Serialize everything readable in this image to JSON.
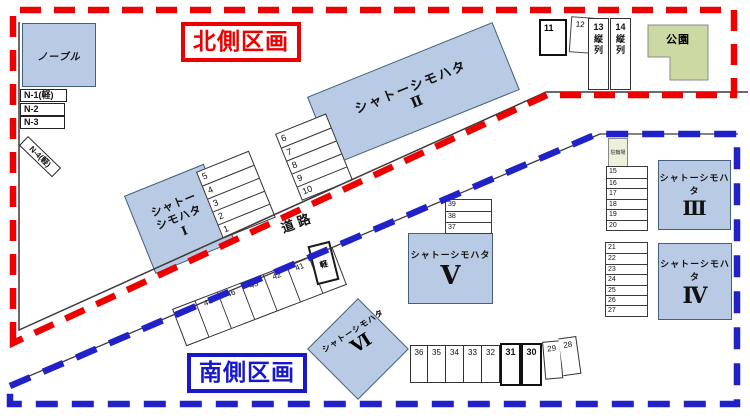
{
  "regions": {
    "north_label": "北側区画",
    "south_label": "南側区画"
  },
  "road_label": "道路",
  "buildings": {
    "noble": "ノーブル",
    "b1": {
      "line1": "シャトー",
      "line2": "シモハタ",
      "numeral": "Ⅰ"
    },
    "b2": {
      "name": "シャトーシモハタ",
      "numeral": "Ⅱ"
    },
    "b3": {
      "name": "シャトーシモハタ",
      "numeral": "Ⅲ"
    },
    "b4": {
      "name": "シャトーシモハタ",
      "numeral": "Ⅳ"
    },
    "b5": {
      "name": "シャトーシモハタ",
      "numeral": "Ⅴ"
    },
    "b6": {
      "name": "シャトーシモハタ",
      "numeral": "Ⅵ"
    },
    "park": "公園",
    "bicycle_shed": "駐輪場"
  },
  "spaces": {
    "n_row": [
      "N-1(軽)",
      "N-2",
      "N-3"
    ],
    "n4": "N-4(軽)",
    "stack_5_1": [
      "5",
      "4",
      "3",
      "2",
      "1"
    ],
    "stack_6_10": [
      "6",
      "7",
      "8",
      "9",
      "10"
    ],
    "box_11": "11",
    "box_12": "12",
    "tandem_13": {
      "num": "13",
      "label": "縦列"
    },
    "tandem_14": {
      "num": "14",
      "label": "縦列"
    },
    "col_15_20": [
      "15",
      "16",
      "17",
      "18",
      "19",
      "20"
    ],
    "col_21_27": [
      "21",
      "22",
      "23",
      "24",
      "25",
      "26",
      "27"
    ],
    "col_39_37": [
      "39",
      "38",
      "37"
    ],
    "diag_row": [
      "45",
      "44",
      "46",
      "43",
      "42",
      "41",
      "40"
    ],
    "space_47": {
      "num": "47",
      "label": "軽"
    },
    "bottom_row": [
      "36",
      "35",
      "34",
      "33",
      "32",
      "31",
      "30",
      "29",
      "28"
    ]
  },
  "colors": {
    "north_border": "#ee0000",
    "south_border": "#1717cd",
    "building_fill": "#b9cbe4",
    "park_fill": "#ccd9a3",
    "road_line": "#333333"
  }
}
